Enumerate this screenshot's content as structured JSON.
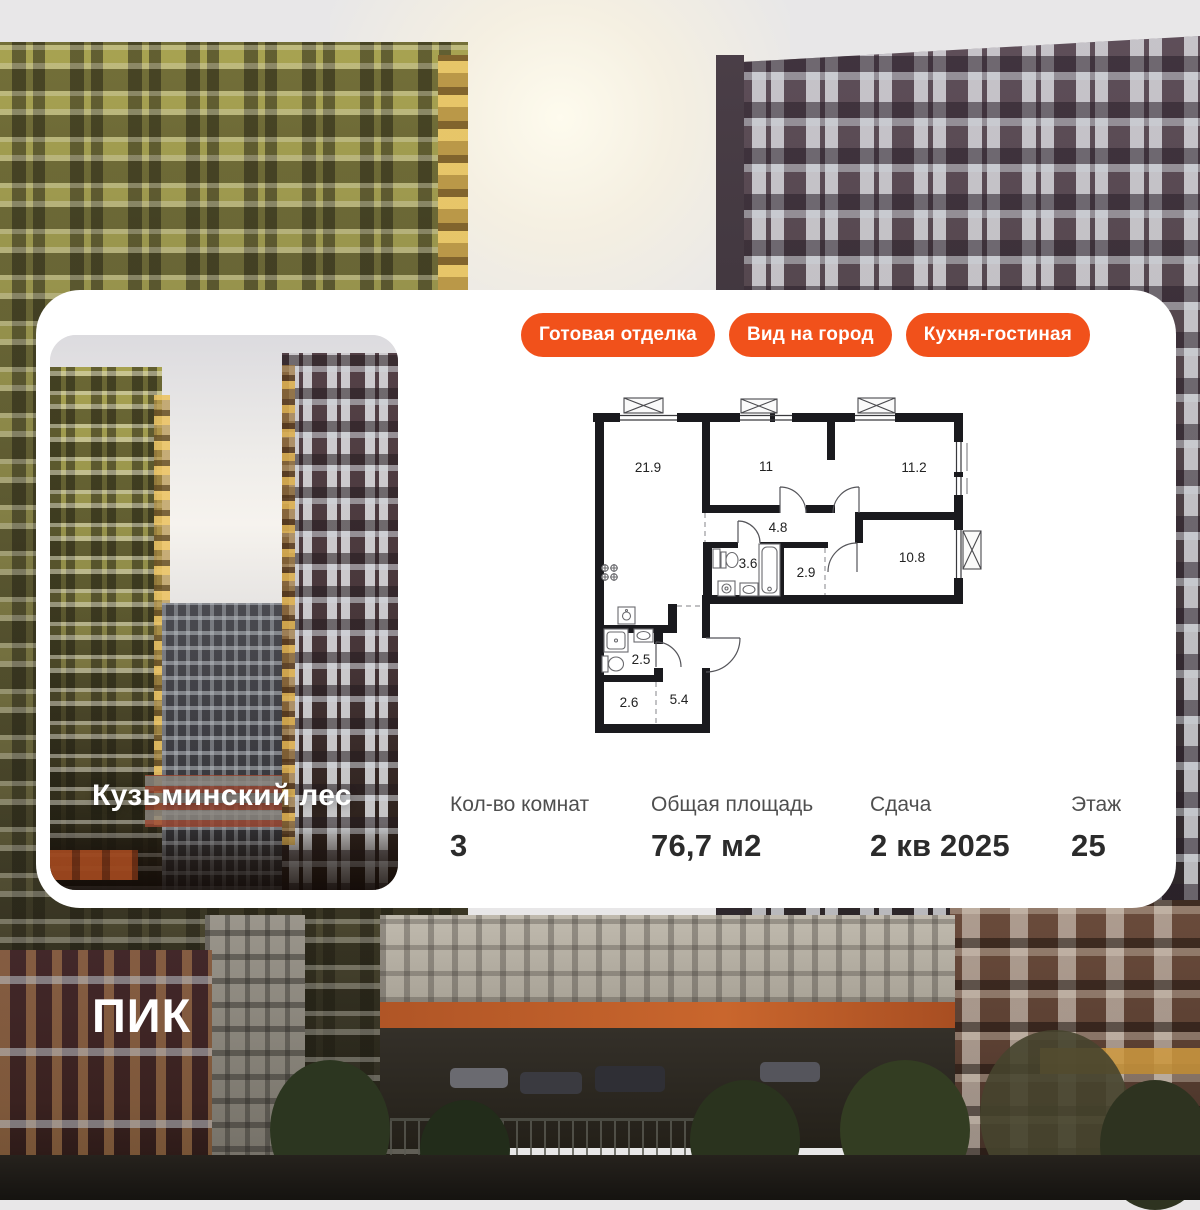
{
  "theme": {
    "accent_orange": "#F1511B",
    "card_bg": "#FFFFFF",
    "wall_color": "#1A1A1E"
  },
  "badges": [
    {
      "label": "Готовая отделка"
    },
    {
      "label": "Вид на город"
    },
    {
      "label": "Кухня-гостиная"
    }
  ],
  "project": {
    "name": "Кузьминский лес"
  },
  "floorplan": {
    "rooms": [
      {
        "area": "21.9"
      },
      {
        "area": "11"
      },
      {
        "area": "11.2"
      },
      {
        "area": "4.8"
      },
      {
        "area": "3.6"
      },
      {
        "area": "2.9"
      },
      {
        "area": "10.8"
      },
      {
        "area": "2.5"
      },
      {
        "area": "2.6"
      },
      {
        "area": "5.4"
      }
    ]
  },
  "stats": [
    {
      "label": "Кол-во комнат",
      "value": "3"
    },
    {
      "label": "Общая площадь",
      "value": "76,7 м2"
    },
    {
      "label": "Сдача",
      "value": "2 кв 2025"
    },
    {
      "label": "Этаж",
      "value": "25"
    }
  ],
  "logo": {
    "text": "ПИК"
  }
}
